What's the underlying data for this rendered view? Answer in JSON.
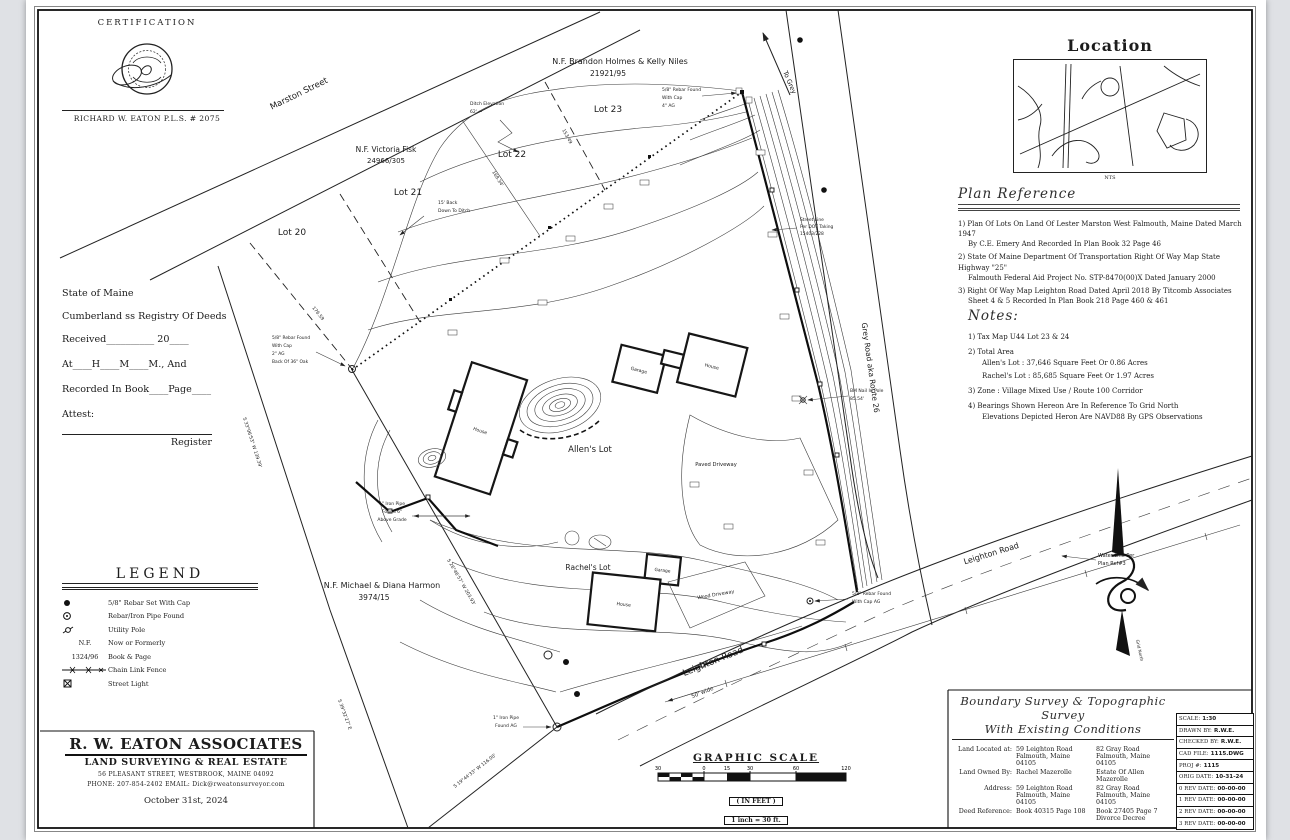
{
  "certification": {
    "title": "CERTIFICATION",
    "surveyor": "RICHARD W. EATON  P.L.S. # 2075"
  },
  "registry": {
    "lines": [
      "State of Maine",
      "Cumberland  ss Registry Of Deeds",
      "Received__________ 20____",
      "At____H____M____M., And",
      "Recorded In Book____Page____",
      "Attest:"
    ],
    "signature_label": "Register"
  },
  "legend": {
    "title": "LEGEND",
    "items": [
      {
        "sym": "rebar-set-symbol",
        "label": "5/8\" Rebar Set With Cap"
      },
      {
        "sym": "pipe-found-symbol",
        "label": "Rebar/Iron Pipe Found"
      },
      {
        "sym": "utility-pole-symbol",
        "label": "Utility Pole"
      },
      {
        "key": "N.F.",
        "label": "Now or Formerly"
      },
      {
        "key": "1324/96",
        "label": "Book & Page"
      },
      {
        "sym": "chain-link-symbol",
        "label": "Chain Link Fence"
      },
      {
        "sym": "street-light-symbol",
        "label": "Street Light"
      }
    ]
  },
  "firm": {
    "name": "R. W. EATON ASSOCIATES",
    "tagline": "LAND SURVEYING & REAL ESTATE",
    "address": "56 PLEASANT STREET, WESTBROOK, MAINE 04092",
    "contact": "PHONE: 207-854-2402   EMAIL: Dick@rweatonsurveyor.com",
    "date": "October 31st, 2024"
  },
  "location": {
    "title": "Location",
    "scale": "NTS"
  },
  "plan_reference": {
    "title": "Plan Reference",
    "items": [
      {
        "l1": "1) Plan Of Lots On Land Of Lester Marston West Falmouth, Maine Dated March 1947",
        "l2": "By C.E. Emery And Recorded In Plan Book 32 Page 46"
      },
      {
        "l1": "2) State Of Maine Department Of Transportation Right Of Way Map State Highway \"25\"",
        "l2": "Falmouth Federal Aid Project No. STP-8470(00)X Dated January 2000"
      },
      {
        "l1": "3) Right Of Way Map Leighton Road Dated April 2018 By Titcomb Associates",
        "l2": "Sheet 4 & 5 Recorded In Plan Book 218 Page 460 & 461"
      }
    ]
  },
  "notes": {
    "title": "Notes:",
    "items": [
      "1) Tax Map U44 Lot 23 & 24",
      "2) Total Area",
      "Allen's Lot : 37,646 Square Feet Or 0.86 Acres",
      "Rachel's Lot : 85,685 Square Feet Or 1.97 Acres",
      "3) Zone : Village Mixed Use / Route 100 Corridor",
      "4) Bearings Shown Hereon Are In Reference To Grid North",
      "Elevations Depicted Heron Are NAVD88 By GPS Observations"
    ]
  },
  "title_block": {
    "title1": "Boundary Survey & Topographic Survey",
    "title2": "With Existing Conditions",
    "rows": {
      "located_label": "Land Located at:",
      "located_a1": "59 Leighton Road",
      "located_a2": "Falmouth, Maine 04105",
      "located_b1": "82 Gray Road",
      "located_b2": "Falmouth, Maine 04105",
      "owned_label": "Land Owned By:",
      "owned_a": "Rachel Mazerolle",
      "owned_b": "Estate Of Allen Mazerolle",
      "address_label": "Address:",
      "address_a1": "59 Leighton Road",
      "address_a2": "Falmouth, Maine 04105",
      "address_b1": "82 Gray Road",
      "address_b2": "Falmouth, Maine 04105",
      "deed_label": "Deed Reference:",
      "deed_a": "Book 40315 Page 108",
      "deed_b1": "Book 27405 Page 7",
      "deed_b2": "Divorce Decree"
    }
  },
  "info_table": {
    "rows": [
      [
        "SCALE:",
        "1:30"
      ],
      [
        "DRAWN BY:",
        "R.W.E."
      ],
      [
        "CHECKED BY:",
        "R.W.E."
      ],
      [
        "CAD FILE:",
        "1115.DWG"
      ],
      [
        "PROJ #:",
        "1115"
      ],
      [
        "ORIG DATE:",
        "10-31-24"
      ],
      [
        "0 REV DATE:",
        "00-00-00"
      ],
      [
        "1 REV DATE:",
        "00-00-00"
      ],
      [
        "2 REV DATE:",
        "00-00-00"
      ],
      [
        "3 REV DATE:",
        "00-00-00"
      ]
    ]
  },
  "graphic_scale": {
    "title": "GRAPHIC SCALE",
    "ticks": [
      "30",
      "0",
      "15",
      "30",
      "60",
      "120"
    ],
    "in_feet": "( IN FEET )",
    "ratio": "1 inch = 30  ft."
  },
  "map": {
    "streets": {
      "marston": "Marston Street",
      "to_grey": "To Grey",
      "grey_road": "Grey Road aka Route 26",
      "leighton": "Leighton Road",
      "leighton_width": "50' wide",
      "leighton_east": "Leighton Road"
    },
    "lots": {
      "lot20": "Lot 20",
      "lot21": "Lot 21",
      "lot22": "Lot 22",
      "lot23": "Lot 23"
    },
    "owners": {
      "holmes1": "N.F. Brandon Holmes & Kelly Niles",
      "holmes2": "21921/95",
      "fisk1": "N.F. Victoria Fisk",
      "fisk2": "24966/305",
      "harmon1": "N.F. Michael & Diana Harmon",
      "harmon2": "3974/15"
    },
    "parcels": {
      "allens": "Allen's Lot",
      "rachels": "Rachel's Lot"
    },
    "features": {
      "house": "House",
      "garage": "Garage",
      "house2": "House",
      "garage2": "Garage",
      "house3": "House",
      "paved": "Paved Driveway",
      "wood": "Wood Driveway"
    },
    "annotations": {
      "ditch": [
        "Ditch Elevation",
        "62'  ←"
      ],
      "back_ditch": [
        "15' Back",
        "Down To Ditch"
      ],
      "rebar_top": [
        "5/8\" Rebar Found",
        "With Cap",
        "4\" AG"
      ],
      "rebar_west": [
        "5/8\" Rebar Found",
        "With Cap",
        "2\" AG",
        "Back Of 36\" Oak"
      ],
      "rebar_se": [
        "5/8\" Rebar Found",
        "With Cap AG"
      ],
      "pipe_mid": [
        "1\" Iron Pipe",
        "Found 6\"",
        "Above Grade"
      ],
      "pipe_sw": [
        "1\" Iron Pipe",
        "Found AG"
      ],
      "bm": [
        "BM Nail In Pole",
        "85.54'"
      ],
      "dot_taking": [
        "Street Line",
        "Per DOT Taking",
        "15403/228"
      ],
      "water": [
        "Water Line Per",
        "Plan Ref#3"
      ],
      "grid_north": "Grid North"
    },
    "dimensions": {
      "d_168": "168.34'",
      "d_176": "176.59",
      "d_153": "153.49",
      "b_sw": "S 33°06'53\" W  139.39'",
      "b_west": "S 26°46'57\" W  203.93'",
      "b_se": "S 39°32'27\" E",
      "b_bottom": "S 19°44'33\" W  116.00'"
    }
  }
}
